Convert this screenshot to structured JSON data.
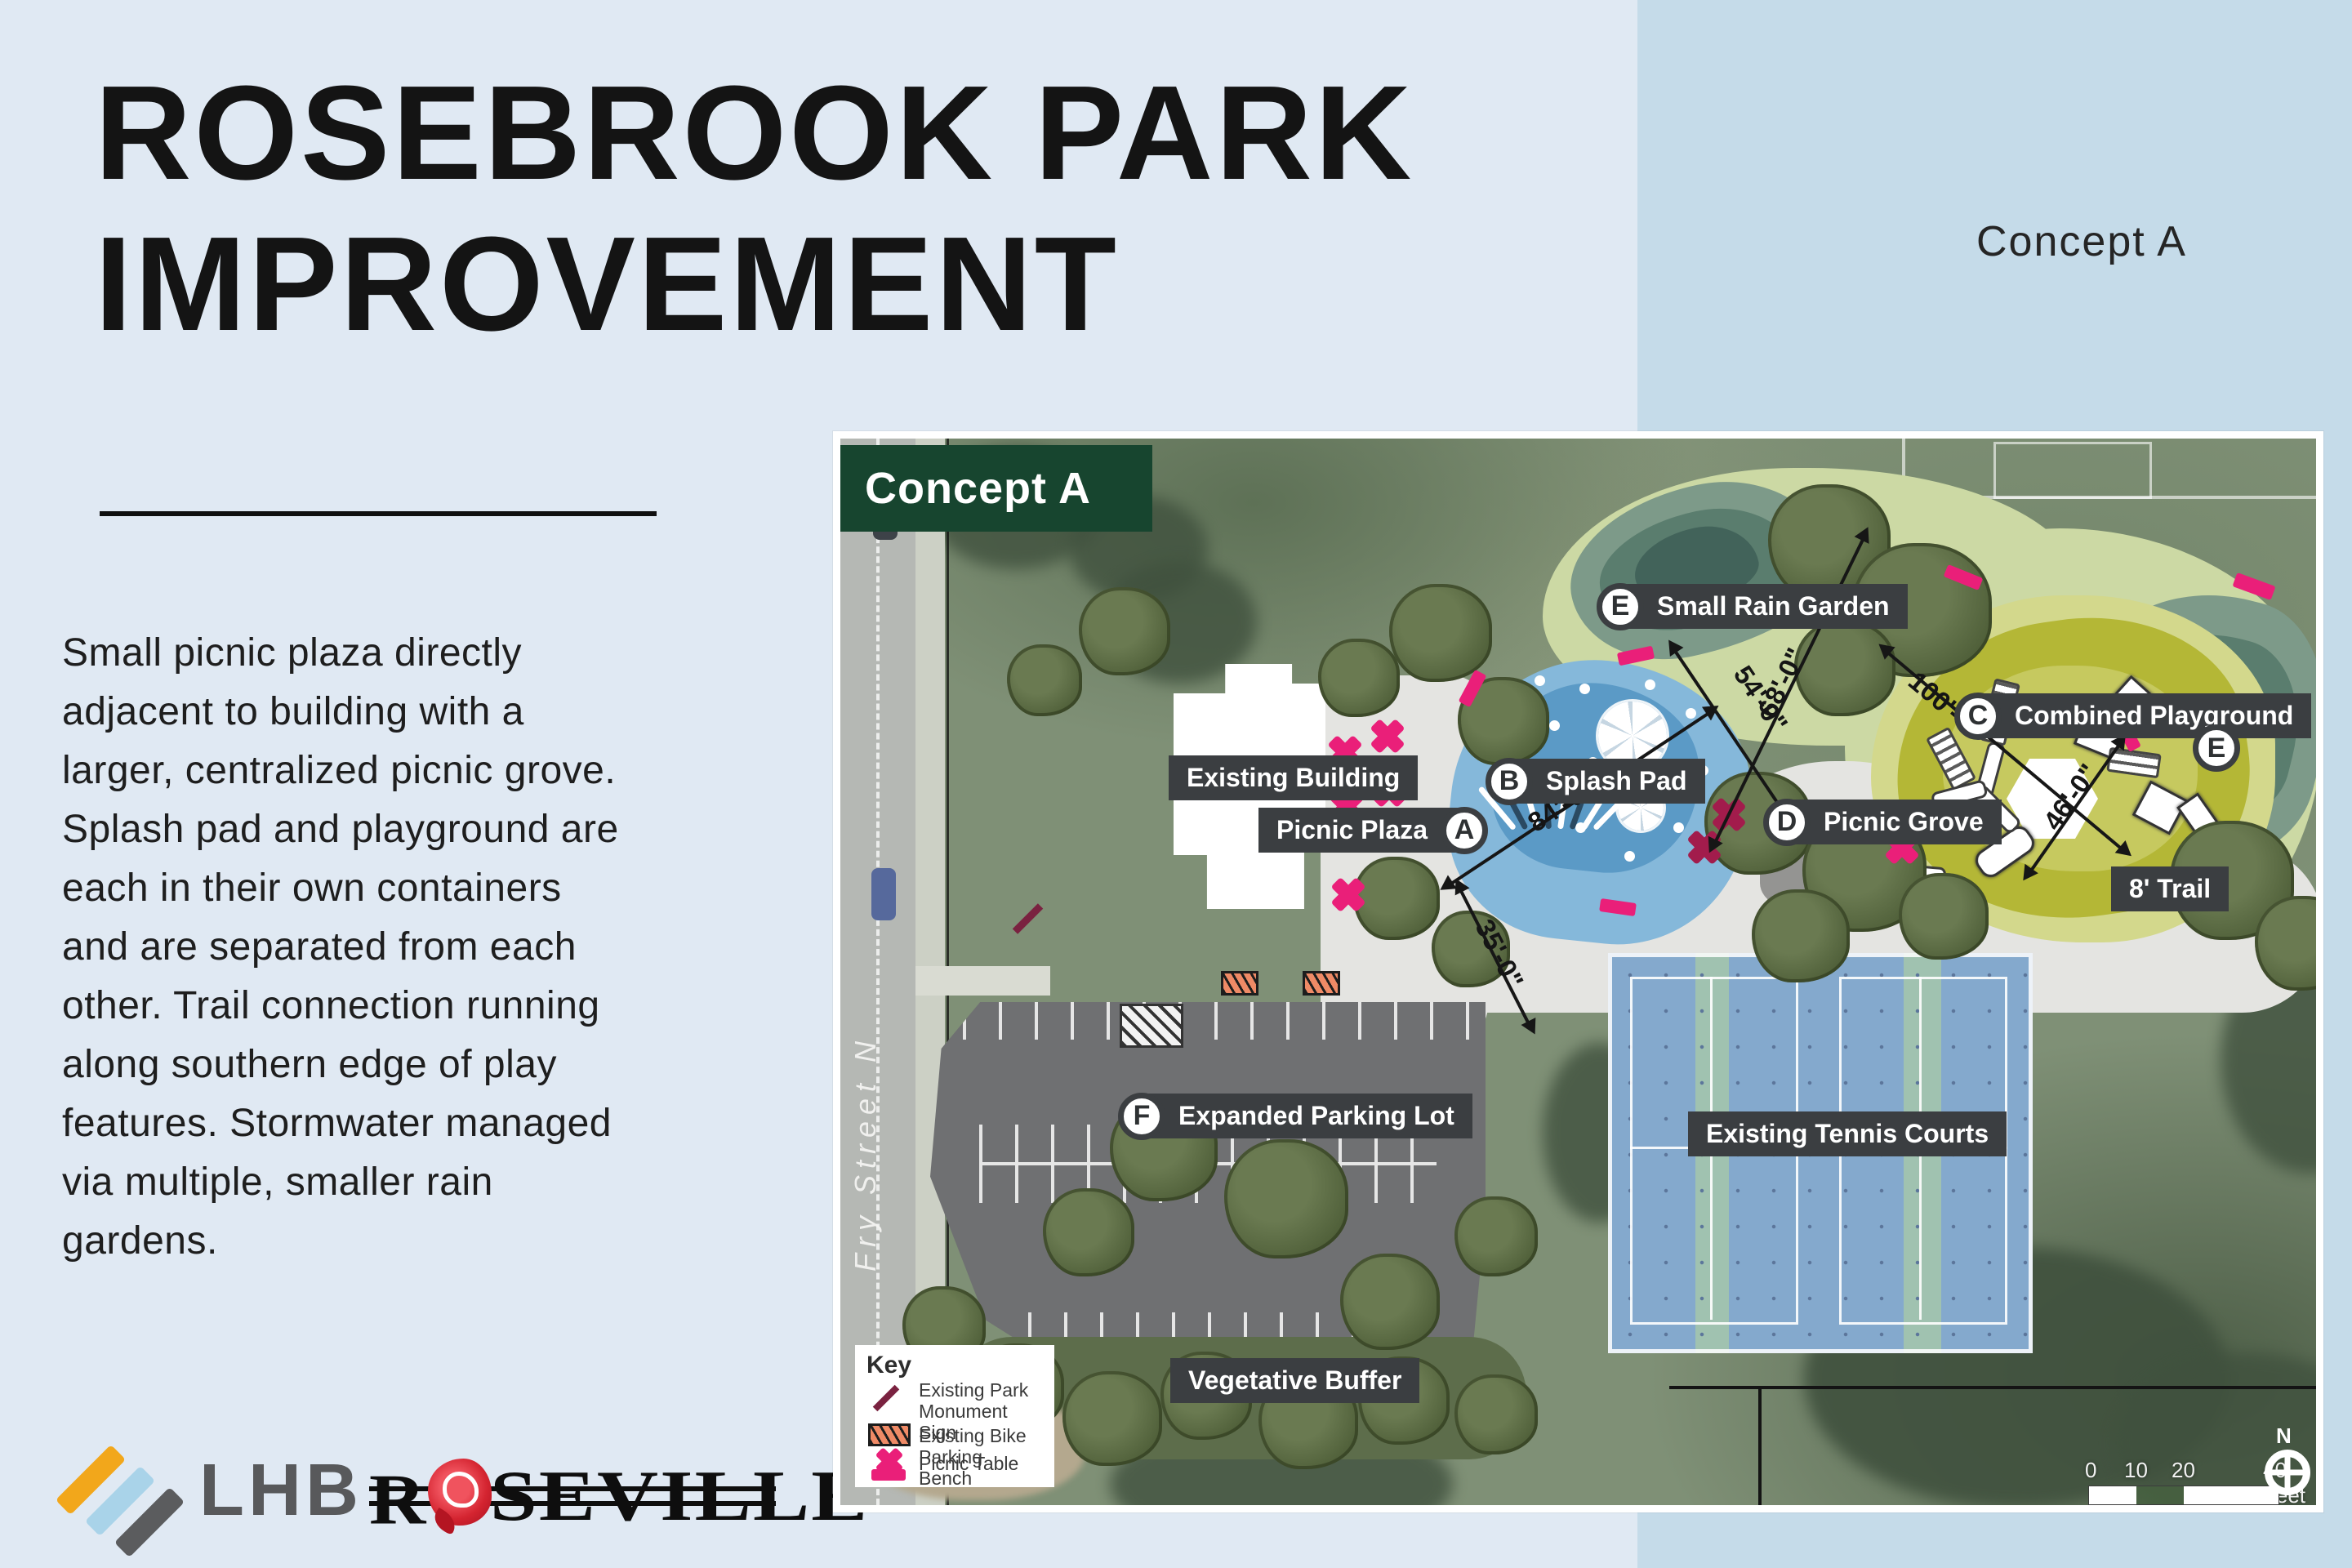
{
  "slide": {
    "title_line1": "ROSEBROOK PARK",
    "title_line2": "IMPROVEMENT",
    "concept_label": "Concept A",
    "description_lines": [
      "Small picnic plaza directly",
      "adjacent to building with a",
      "larger, centralized picnic grove.",
      "Splash pad and playground are",
      "each in their own containers",
      "and are separated from each",
      "other. Trail connection running",
      "along southern edge of play",
      "features. Stormwater managed",
      "via multiple, smaller rain",
      "gardens."
    ]
  },
  "map": {
    "title": "Concept A",
    "labels": {
      "existing_building": "Existing Building",
      "picnic_plaza": "Picnic Plaza",
      "picnic_plaza_letter": "A",
      "splash_pad": "Splash Pad",
      "splash_pad_letter": "B",
      "combined_playground": "Combined Playground",
      "combined_playground_letter": "C",
      "picnic_grove": "Picnic Grove",
      "picnic_grove_letter": "D",
      "small_rain_garden": "Small Rain Garden",
      "small_rain_garden_letter": "E",
      "rain_garden_marker_letter": "E",
      "expanded_parking_lot": "Expanded Parking Lot",
      "expanded_parking_lot_letter": "F",
      "trail": "8' Trail",
      "existing_tennis_courts": "Existing Tennis Courts",
      "vegetative_buffer": "Vegetative Buffer",
      "street_name": "Fry Street N",
      "parcel_number": "912"
    },
    "dimensions": {
      "splash_diag_long": "84'-0\"",
      "splash_diag_short": "54'-0\"",
      "plaza_width": "35'-0\"",
      "playground_diag": "68'-0\"",
      "playground_length": "100'-0\"",
      "playground_width": "46'-0\""
    },
    "key": {
      "title": "Key",
      "items": [
        {
          "icon": "monument-sign-icon",
          "label": "Existing Park Monument Sign"
        },
        {
          "icon": "bike-parking-icon",
          "label": "Existing Bike Parking"
        },
        {
          "icon": "picnic-table-icon",
          "label": "Picnic Table"
        },
        {
          "icon": "bench-icon",
          "label": "Bench"
        }
      ]
    },
    "scale_bar": {
      "tick0": "0",
      "tick1": "10",
      "tick2": "20",
      "tick3": "40 Feet",
      "north": "N"
    }
  },
  "footer": {
    "lhb_logo_text": "LHB",
    "roseville_logo_prefix": "R",
    "roseville_logo_suffix": "SEVILLE"
  }
}
